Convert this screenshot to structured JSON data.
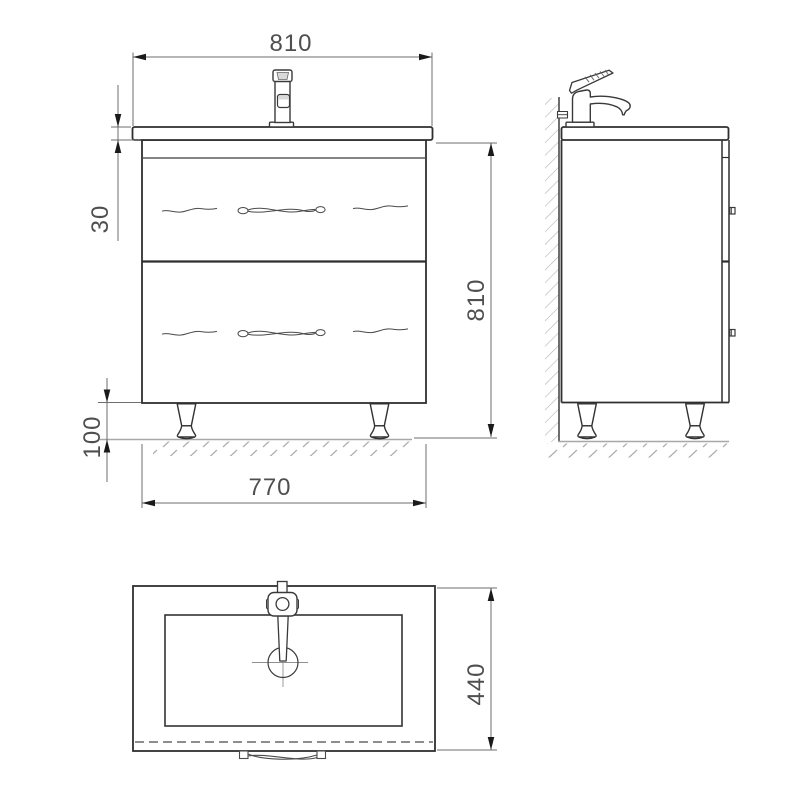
{
  "drawing": {
    "dims": {
      "width_top": "810",
      "counter_thickness": "30",
      "overall_height": "810",
      "leg_height": "100",
      "cabinet_width": "770",
      "depth": "440"
    },
    "colors": {
      "outline": "#2f2f2f",
      "dim_line": "#6e6e6e",
      "dim_text": "#4f4f4f",
      "arrow": "#1a1a1a",
      "hatch": "#b3b3b3",
      "ground": "#a8a8a8",
      "background": "#ffffff"
    }
  }
}
